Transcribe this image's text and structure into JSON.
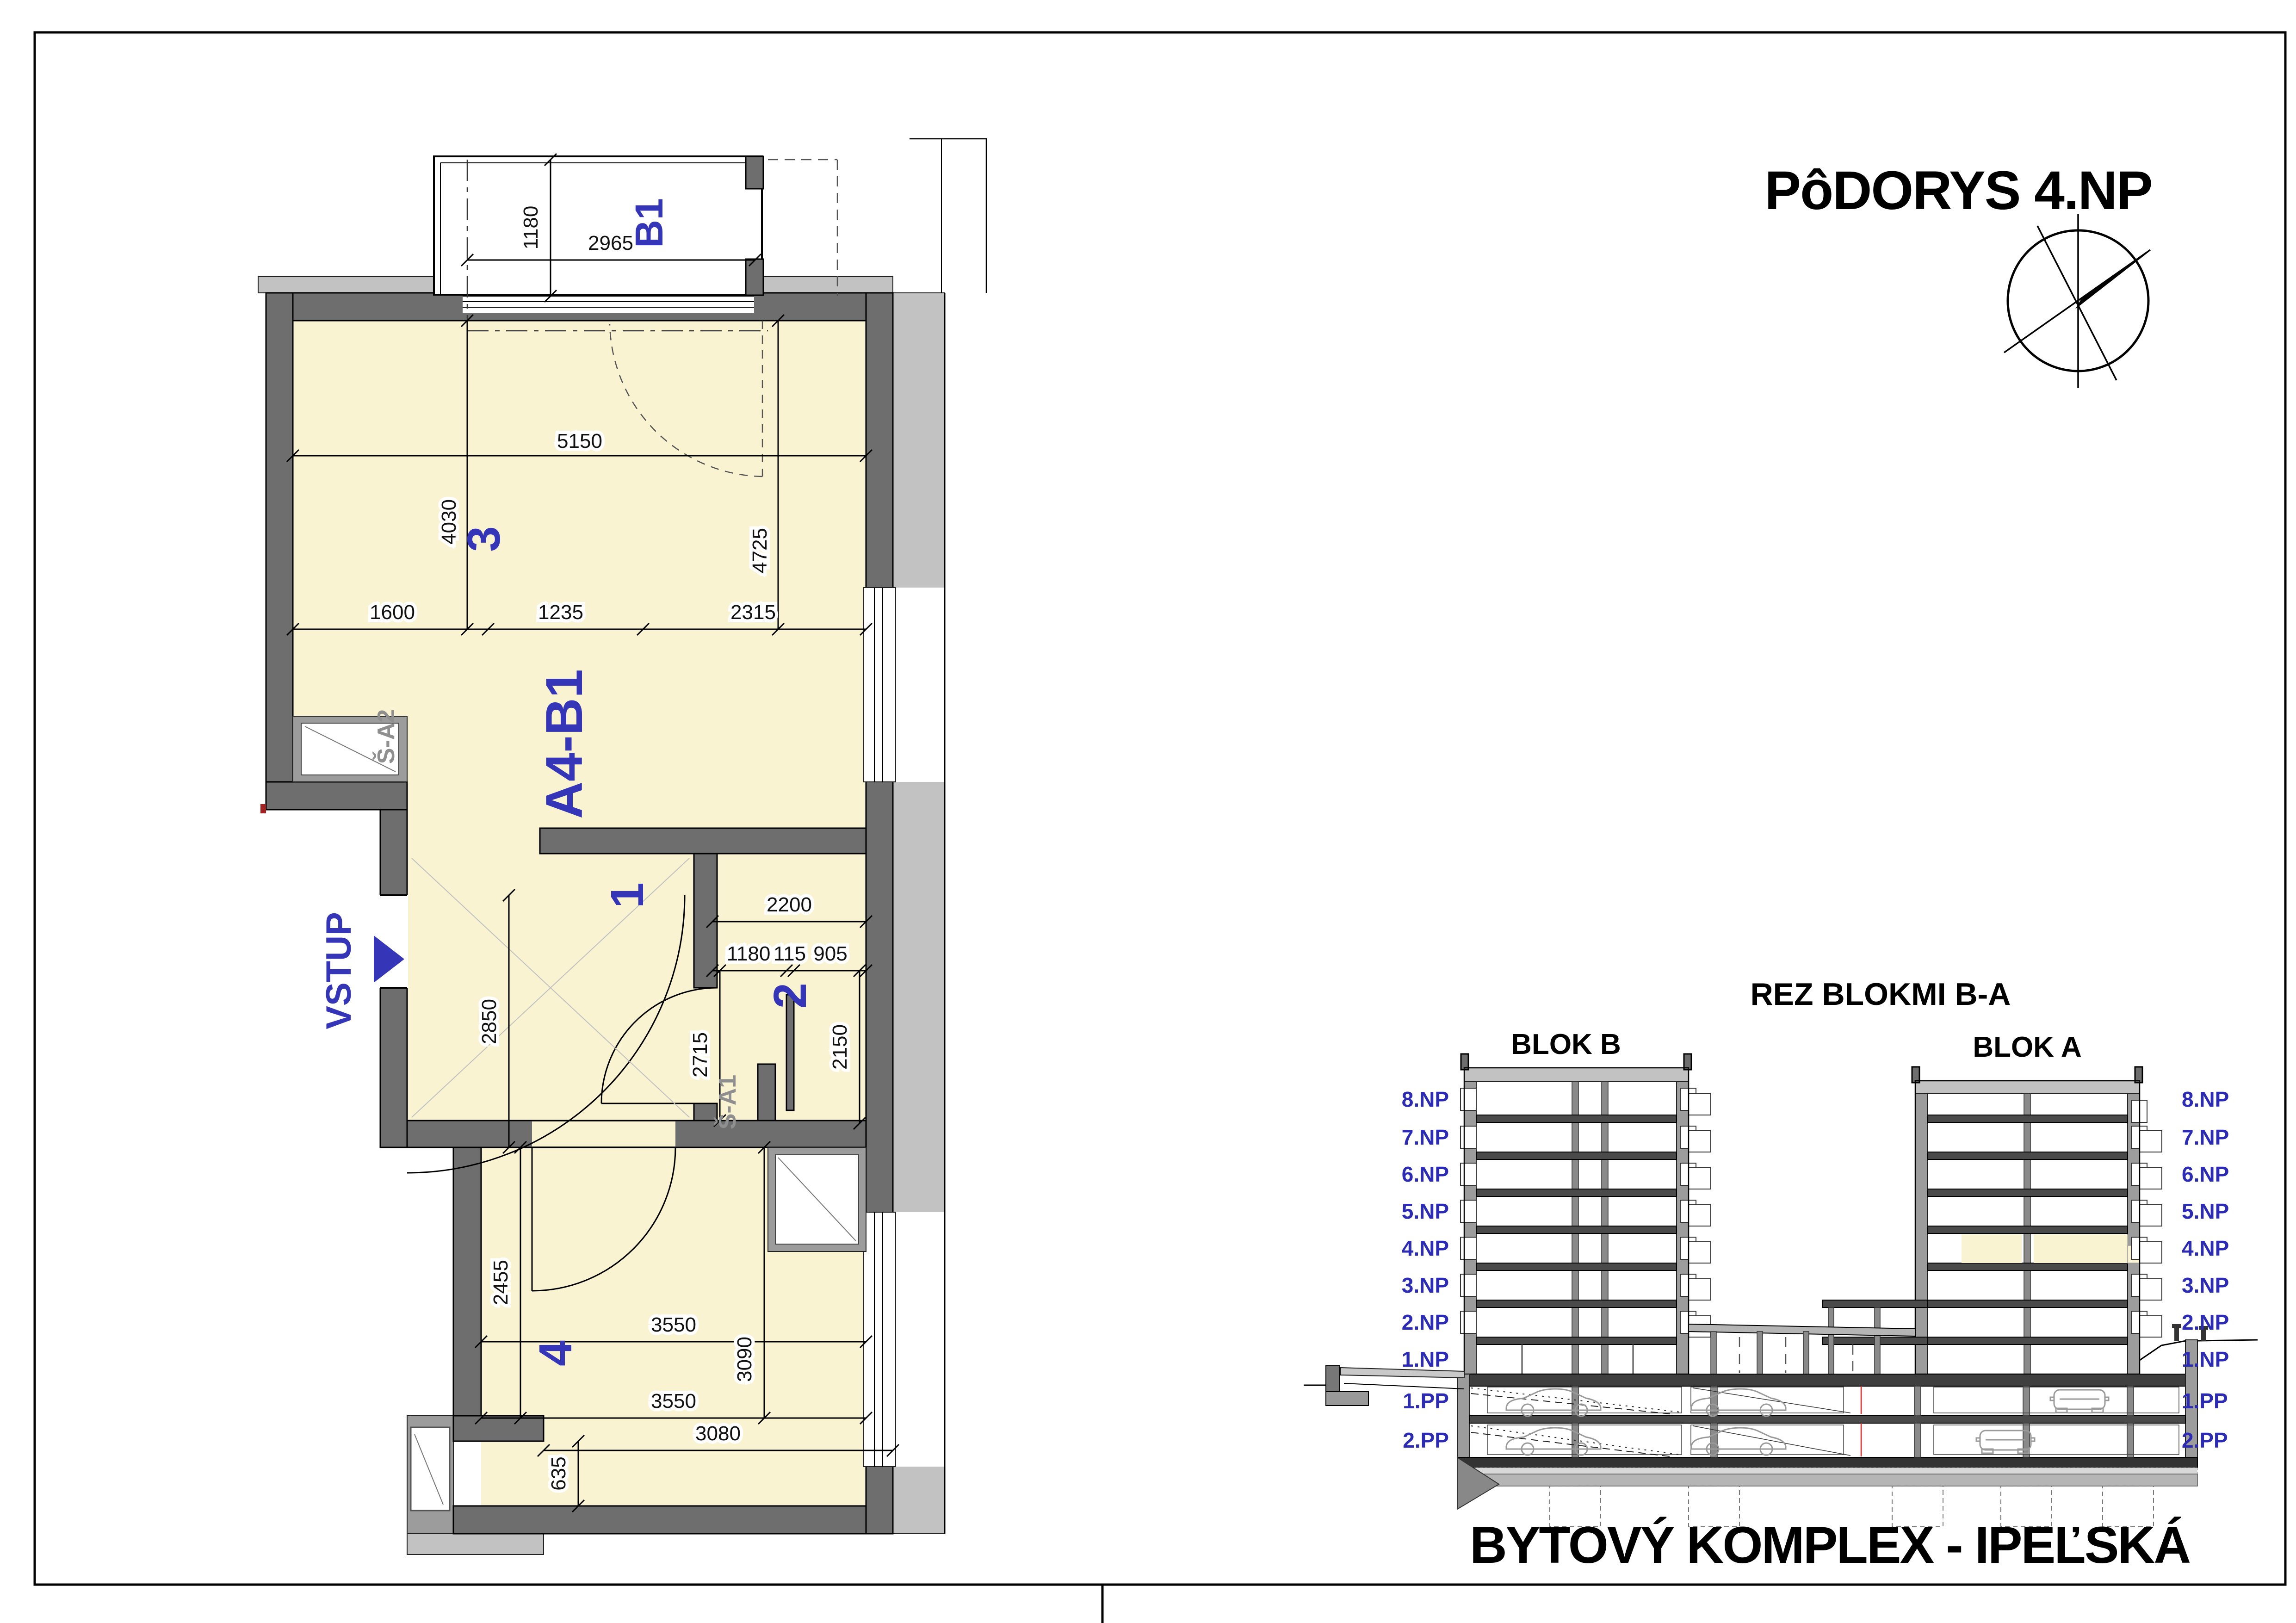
{
  "sheet": {
    "title": "PôDORYS 4.NP",
    "footer": "BYTOVÝ KOMPLEX - IPEĽSKÁ"
  },
  "colors": {
    "accent_blue": "#3535b8",
    "room_fill": "#faf3d2",
    "wall_dark": "#6e6e6e",
    "wall_mid": "#9c9c9c",
    "wall_light": "#c2c2c2",
    "shaft_label_gray": "#8f8f8f",
    "highlight_yellow": "#faf3d2"
  },
  "icons": {
    "compass": "compass-rose-icon",
    "entrance_arrow": "arrow-right-icon"
  },
  "plan": {
    "balcony": {
      "label": "B1",
      "depth": "1180",
      "width": "2965"
    },
    "unit_label": "A4-B1",
    "entrance_label": "VSTUP",
    "room_numbers": {
      "hall": "1",
      "bath": "2",
      "living": "3",
      "bedroom": "4"
    },
    "shafts": {
      "s1": "Š-A1",
      "s2": "Š-A2"
    },
    "dims": {
      "living_width": "5150",
      "living_height_left": "4030",
      "living_height_right": "4725",
      "seg_1600": "1600",
      "seg_1235": "1235",
      "seg_2315": "2315",
      "hall_height": "2850",
      "bath_width": "2200",
      "bath_seg_a": "1180",
      "bath_seg_b": "115",
      "bath_seg_c": "905",
      "bath_height": "2150",
      "corridor_height": "2715",
      "bedroom_width_top": "3550",
      "bedroom_height_left": "2455",
      "bedroom_height_right": "3090",
      "bedroom_width_bottom": "3550",
      "bedroom_width_outer": "3080",
      "bedroom_notch": "635"
    }
  },
  "section": {
    "title": "REZ BLOKMI B-A",
    "block_b_label": "BLOK B",
    "block_a_label": "BLOK A",
    "levels": [
      "8.NP",
      "7.NP",
      "6.NP",
      "5.NP",
      "4.NP",
      "3.NP",
      "2.NP",
      "1.NP",
      "1.PP",
      "2.PP"
    ]
  }
}
